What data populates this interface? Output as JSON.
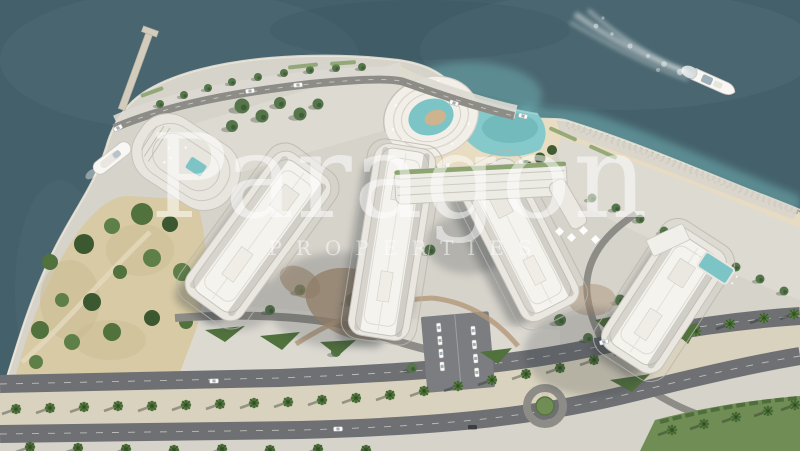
{
  "watermark": {
    "brand": "Paragon",
    "tagline": "PROPERTIES",
    "color": "rgba(255,255,255,0.52)"
  },
  "palette": {
    "sea": "#44616b",
    "shallow_water": "#74b8ba",
    "land": "#d6d3ca",
    "plaza_light": "#e0ddd5",
    "sand_lot": "#d7caa4",
    "beach_sand": "#e8dcc1",
    "lagoon": "#86c9cb",
    "pool": "#7cc4c6",
    "tower_roof": "#f4f3ee",
    "podium": "#e9e7e0",
    "road": "#6e7073",
    "road_internal": "#8e8c87",
    "median": "#d9d2bd",
    "palm": "#5d8046",
    "tree": "#55754a",
    "hedge": "#51713d",
    "lawn": "#6f8d54",
    "shadow": "#2c343b",
    "paving_tan": "#a98f72",
    "surf": "#efe9dc",
    "boat": "#f8f7f4"
  }
}
